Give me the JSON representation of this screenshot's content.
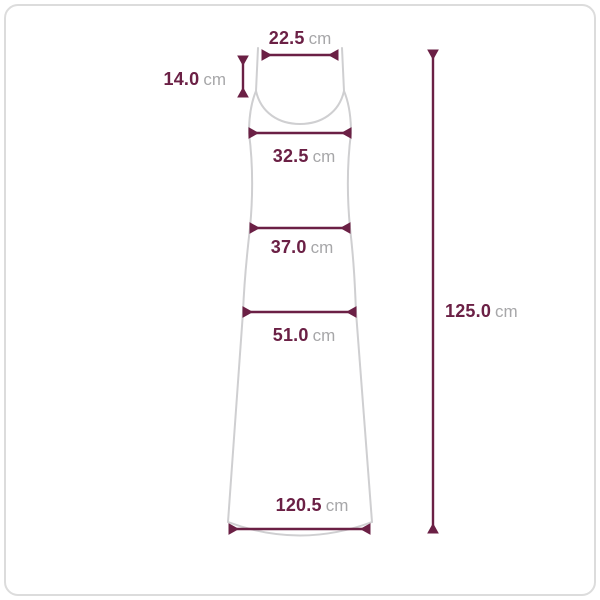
{
  "palette": {
    "accent": "#6b2045",
    "unit_color": "#a7a7a9",
    "garment_outline": "#cfcfd1",
    "border_color": "#dcdcdc",
    "background": "#ffffff"
  },
  "diagram": {
    "subject": "sleeveless-maxi-dress-size-chart",
    "measurements": {
      "top_width": {
        "value": "22.5",
        "unit": "cm"
      },
      "strap_length": {
        "value": "14.0",
        "unit": "cm"
      },
      "bust_width": {
        "value": "32.5",
        "unit": "cm"
      },
      "waist_width": {
        "value": "37.0",
        "unit": "cm"
      },
      "hip_width": {
        "value": "51.0",
        "unit": "cm"
      },
      "hem_width": {
        "value": "120.5",
        "unit": "cm"
      },
      "total_length": {
        "value": "125.0",
        "unit": "cm"
      }
    }
  }
}
